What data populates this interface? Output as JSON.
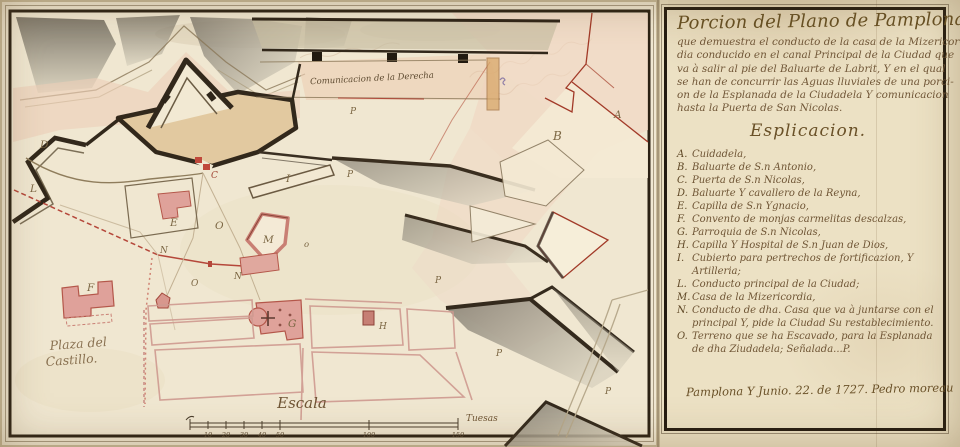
{
  "document": {
    "kind": "manuscript plan",
    "place": "Pamplona",
    "date_text": "1727"
  },
  "panel": {
    "title": "Porcion del Plano de Pamplona",
    "subtitle_lines": [
      "que demuestra el conducto de la casa de la Mizericor-",
      "dia conducido en el canal Principal de la Ciudad que",
      "va à salir al pie del Baluarte de Labrit, Y en el qual",
      "se han de concurrir las Aguas lluviales de una porci-",
      "on de la Esplanada de la Ciudadela Y comunicacion",
      "hasta la Puerta de San Nicolas."
    ],
    "heading": "Esplicacion.",
    "items": [
      {
        "key": "A.",
        "label": "Cuidadela,"
      },
      {
        "key": "B.",
        "label": "Baluarte de S.n Antonio,"
      },
      {
        "key": "C.",
        "label": "Puerta de S.n Nicolas,"
      },
      {
        "key": "D.",
        "label": "Baluarte Y cavallero de la Reyna,"
      },
      {
        "key": "E.",
        "label": "Capilla de S.n Ygnacio,"
      },
      {
        "key": "F.",
        "label": "Convento de monjas carmelitas descalzas,"
      },
      {
        "key": "G.",
        "label": "Parroquia de S.n Nicolas,"
      },
      {
        "key": "H.",
        "label": "Capilla Y Hospital de S.n Juan de Dios,"
      },
      {
        "key": "I.",
        "label": "Cubierto para pertrechos de fortificazion, Y Artilleria;"
      },
      {
        "key": "L.",
        "label": "Conducto principal de la Ciudad;"
      },
      {
        "key": "M.",
        "label": "Casa de la Mizericordia,"
      },
      {
        "key": "N.",
        "label": "Conducto de dha. Casa que va à juntarse con el principal Y, pide la Ciudad Su restablecimiento."
      },
      {
        "key": "O.",
        "label": "Terreno que se ha Escavado, para la Esplanada de dha Ziudadela; Señalada...P."
      }
    ],
    "signature": "Pamplona Y Junio. 22. de 1727. Pedro moreau"
  },
  "map": {
    "labels": {
      "communication": "Comunicacion de la Derecha",
      "plaza_line1": "Plaza del",
      "plaza_line2": "Castillo."
    },
    "scale": {
      "title": "Escala",
      "unit": "Tuesas",
      "ticks": [
        "10",
        "20",
        "30",
        "40",
        "50",
        "100",
        "150"
      ]
    },
    "letter_markers": [
      "A",
      "B",
      "C",
      "D",
      "E",
      "F",
      "G",
      "H",
      "I",
      "L",
      "M",
      "N",
      "N",
      "O",
      "o",
      "O",
      "P",
      "P",
      "P",
      "P",
      "P"
    ],
    "colors": {
      "paper": "#f0e7d1",
      "panel_paper": "#ece1c4",
      "wall_ink": "#32281b",
      "red_outline": "#a23a28",
      "pink_wash": "#eccfb8",
      "building_pink": "#dfa29a",
      "tan_rampart": "#e2c9a0",
      "ink_brown": "#6f5535"
    }
  }
}
